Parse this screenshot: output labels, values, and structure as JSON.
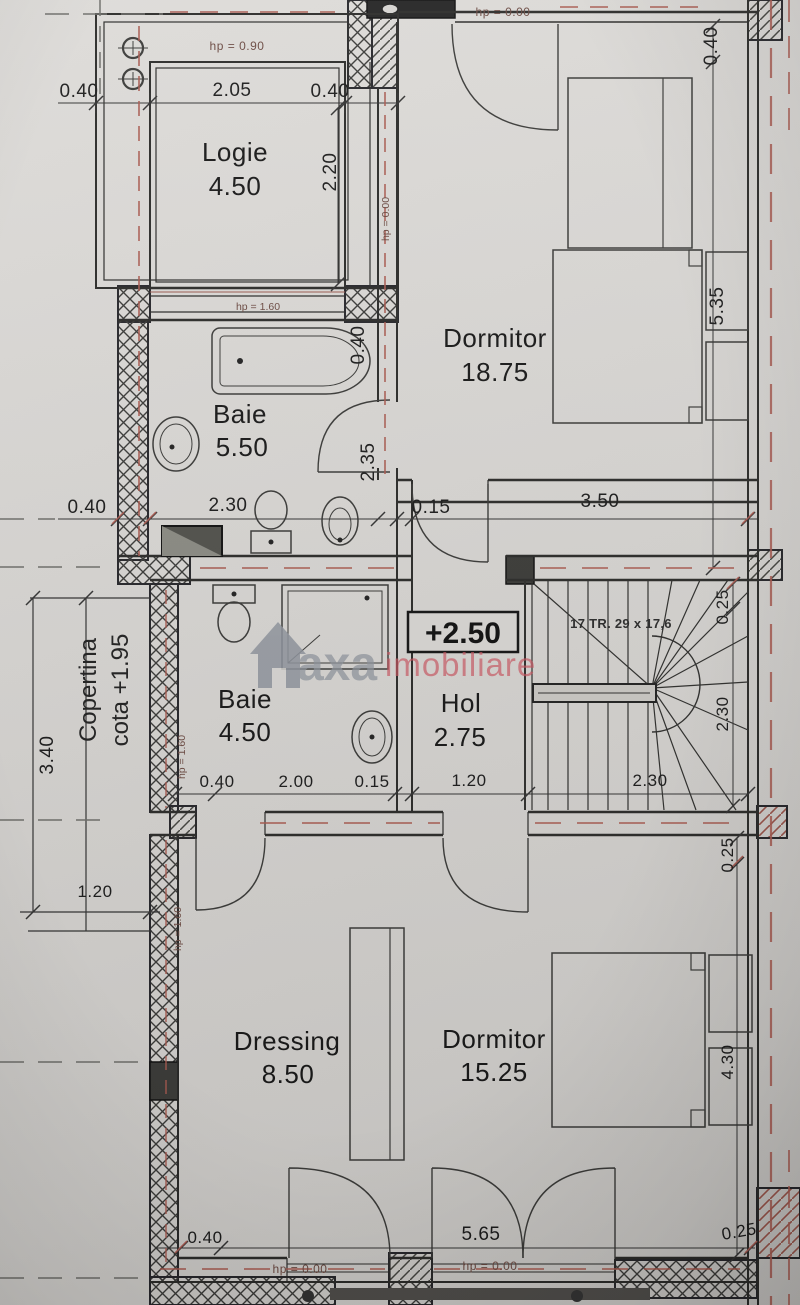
{
  "document": {
    "kind": "floor-plan-photo",
    "level_marker": "+2.50"
  },
  "colors": {
    "paper": "#d6d4d1",
    "line": "#2b2b29",
    "red_dash": "#a85a50",
    "hp_text": "#6b4a42",
    "watermark_gray": "#8e939c",
    "watermark_red": "#c9545f"
  },
  "watermark": {
    "brand_gray": "axa",
    "brand_red": "imobiliare",
    "logo": "house-icon"
  },
  "stairs": {
    "label": "17 TR. 29 x 17,6"
  },
  "copertina": {
    "line1": "Copertina",
    "line2": "cota +1.95"
  },
  "marker": {
    "level": "+2.50"
  },
  "rooms": {
    "logie": {
      "name": "Logie",
      "area": "4.50"
    },
    "dormitor1": {
      "name": "Dormitor",
      "area": "18.75"
    },
    "baie1": {
      "name": "Baie",
      "area": "5.50"
    },
    "baie2": {
      "name": "Baie",
      "area": "4.50"
    },
    "hol": {
      "name": "Hol",
      "area": "2.75"
    },
    "dressing": {
      "name": "Dressing",
      "area": "8.50"
    },
    "dormitor2": {
      "name": "Dormitor",
      "area": "15.25"
    }
  },
  "hp": {
    "p090": "hp = 0.90",
    "p000": "hp = 0.00",
    "p160": "hp = 1.60"
  },
  "dims": {
    "d015": "0.15",
    "d025": "0.25",
    "d040": "0.40",
    "d120": "1.20",
    "d200": "2.00",
    "d205": "2.05",
    "d220": "2.20",
    "d230": "2.30",
    "d235": "2.35",
    "d340": "3.40",
    "d350": "3.50",
    "d430": "4.30",
    "d535": "5.35",
    "d565": "5.65"
  }
}
